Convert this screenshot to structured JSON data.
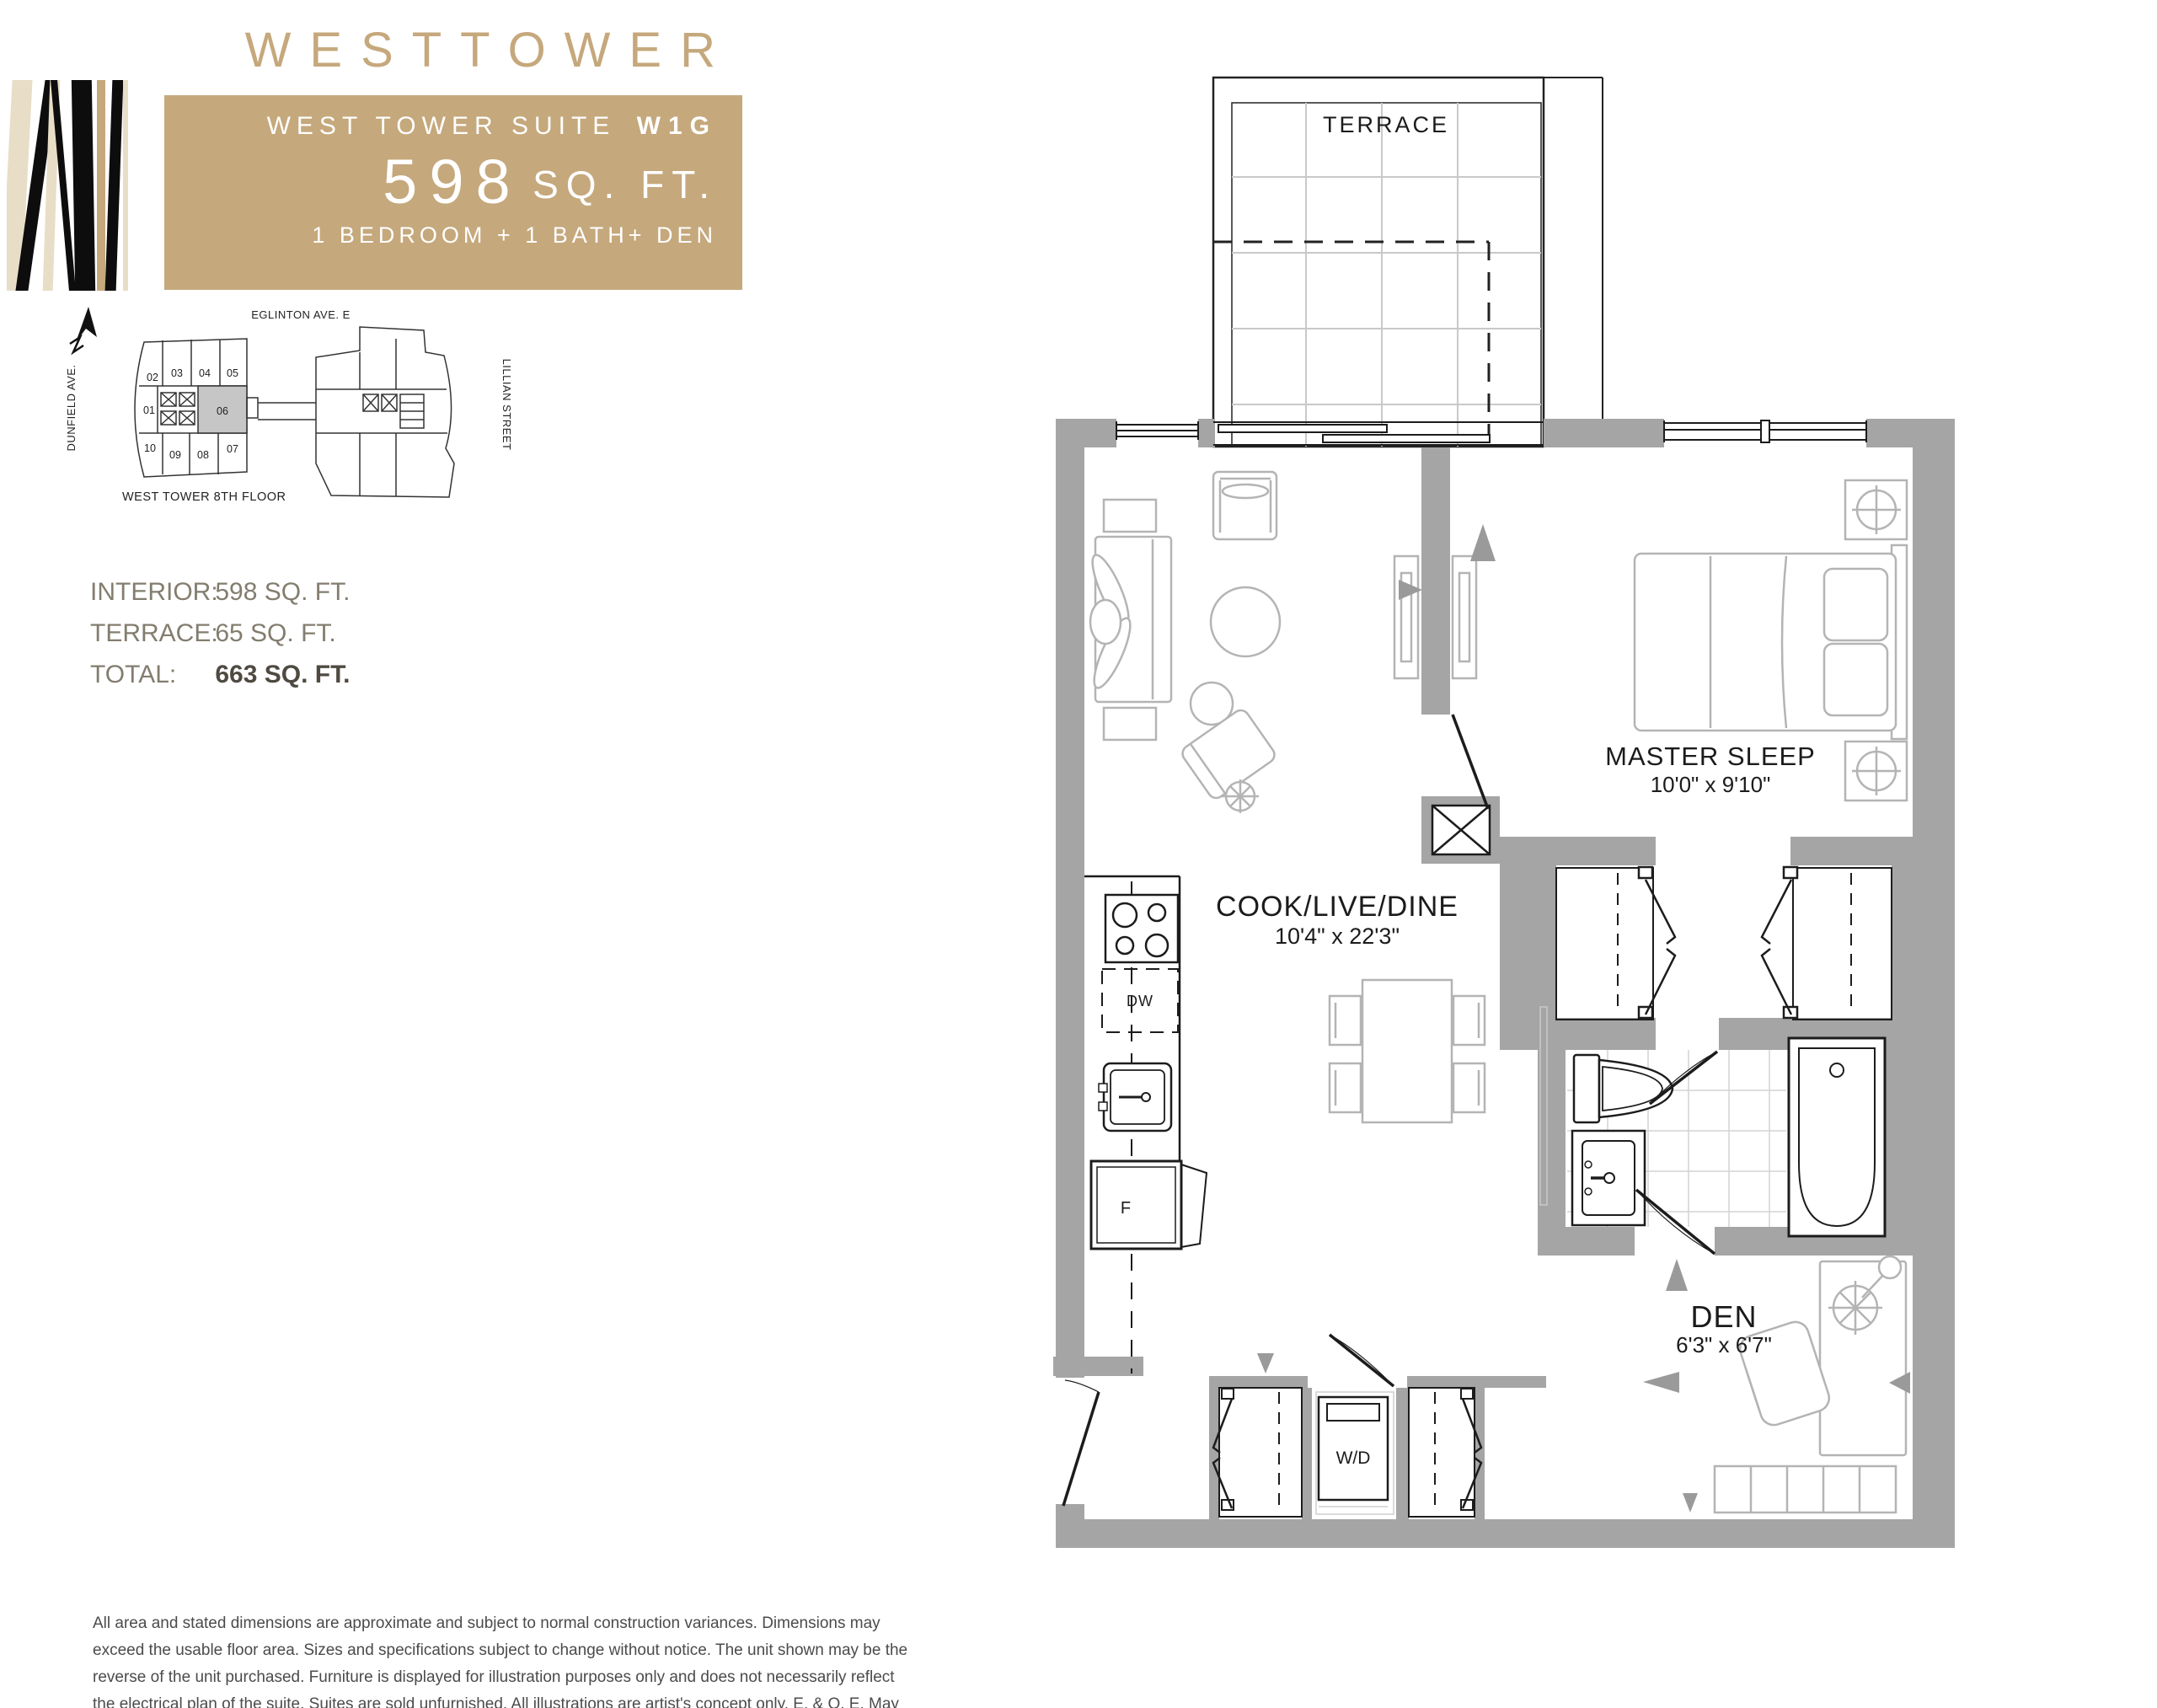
{
  "header": {
    "brand": "WESTTOWER",
    "suite_prefix": "WEST TOWER SUITE",
    "suite_code": "W1G",
    "area_number": "598",
    "area_unit": "SQ. FT.",
    "program": "1 BEDROOM + 1 BATH+ DEN"
  },
  "keyplan": {
    "street_top": "EGLINTON AVE. E",
    "street_left": "DUNFIELD AVE.",
    "street_right": "LILLIAN STREET",
    "floor_label": "WEST TOWER  8TH FLOOR",
    "highlighted_unit": "06",
    "units": [
      "01",
      "02",
      "03",
      "04",
      "05",
      "06",
      "07",
      "08",
      "09",
      "10"
    ]
  },
  "areas": {
    "rows": [
      {
        "label": "INTERIOR:",
        "value": "598 SQ. FT."
      },
      {
        "label": "TERRACE:",
        "value": "65 SQ. FT."
      },
      {
        "label": "TOTAL:",
        "value": "663 SQ. FT."
      }
    ]
  },
  "plan": {
    "terrace_label": "TERRACE",
    "master": {
      "name": "MASTER SLEEP",
      "dims": "10'0\" x 9'10\""
    },
    "cook": {
      "name": "COOK/LIVE/DINE",
      "dims": "10'4\" x 22'3\""
    },
    "den": {
      "name": "DEN",
      "dims": "6'3\" x 6'7\""
    },
    "wd_label": "W/D",
    "dw_label": "DW",
    "fridge_label": "F"
  },
  "disclaimer": "All area and stated dimensions are approximate and subject to normal construction variances. Dimensions may exceed the usable floor area. Sizes and specifications subject to change without notice. The unit shown may be the reverse of the unit purchased. Furniture is displayed for illustration purposes only and does not necessarily reflect the electrical plan of the suite. Suites are sold unfurnished. All illustrations are artist's concept only. E. & O. E. May 2011",
  "colors": {
    "tan": "#c5a87c",
    "wall_gray": "#a5a5a5",
    "unit_highlight": "#c6c6c6",
    "furniture_gray": "#b4b4b4"
  }
}
